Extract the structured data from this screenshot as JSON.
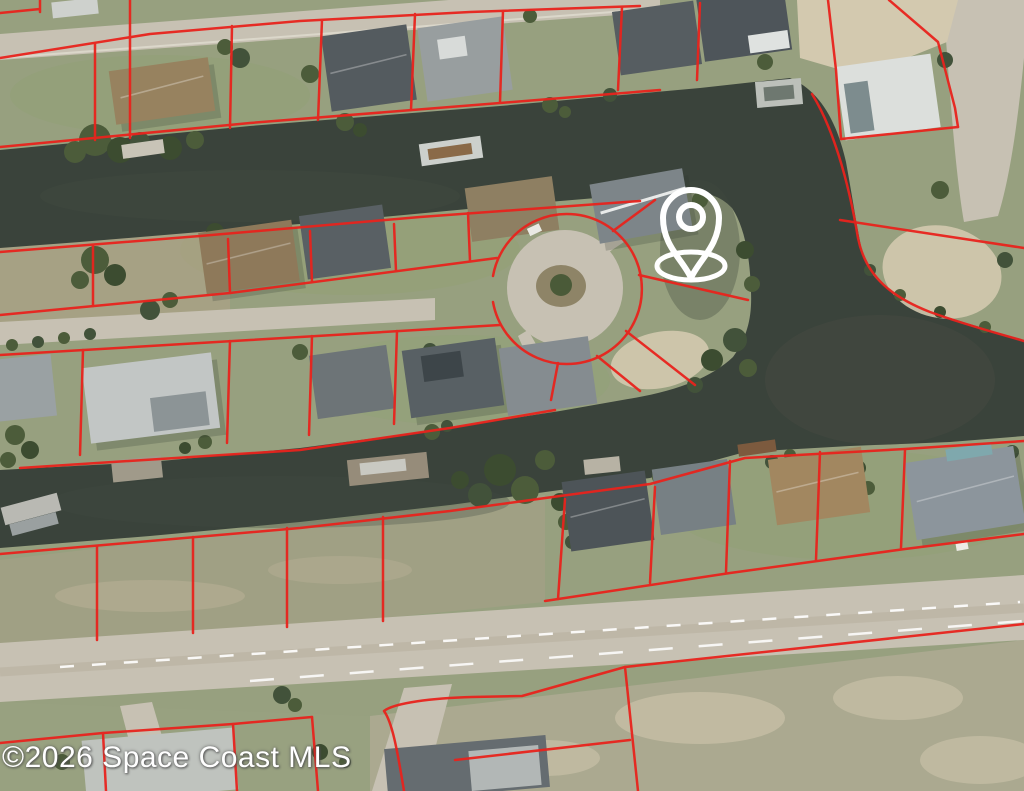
{
  "map": {
    "watermark_text": "©2026 Space Coast MLS",
    "marker": {
      "name": "location-pin",
      "style": "white-outline",
      "tip_x": 691,
      "tip_y": 278
    },
    "overlay": {
      "parcel_line_color": "#e8231d",
      "pin_color": "#ffffff",
      "watermark_color": "#ffffff"
    },
    "terrain_colors": {
      "water": "#3a433b",
      "land": "#97a07f",
      "road": "#c7c1b3",
      "sand": "#d3c9af",
      "tree": "#4c5c3a"
    }
  }
}
